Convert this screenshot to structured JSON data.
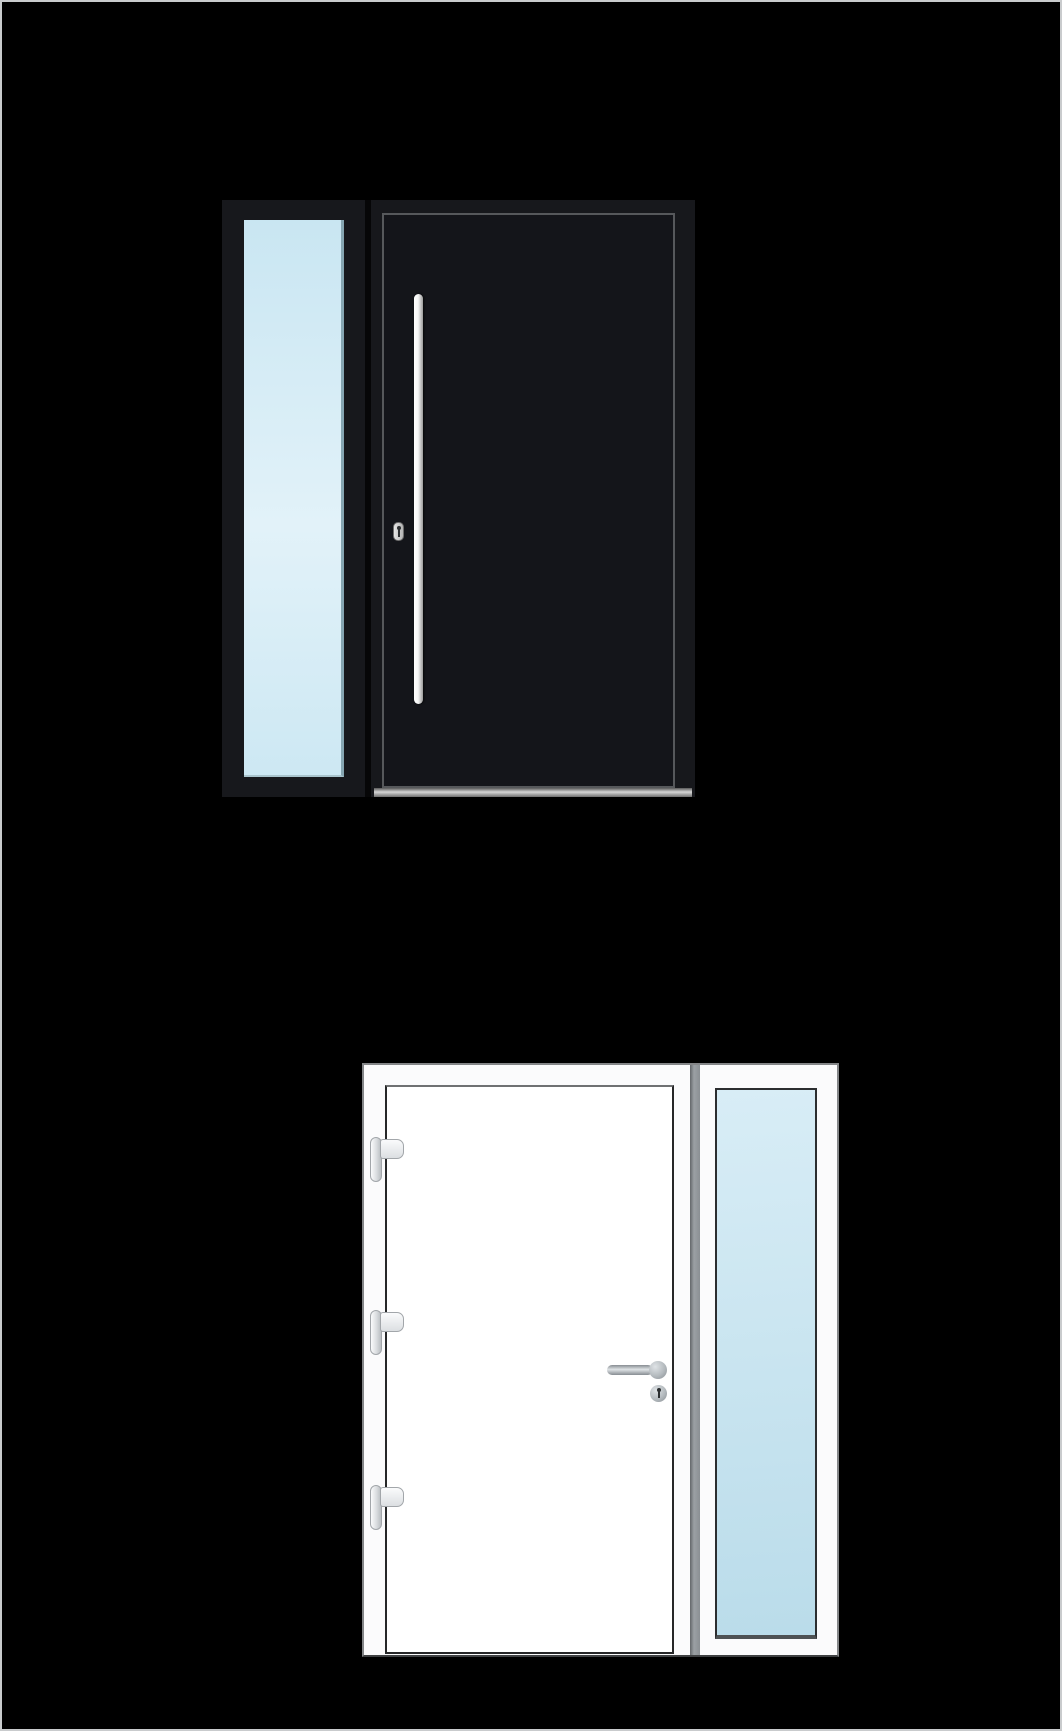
{
  "page": {
    "background_color": "#000000",
    "border_color": "#c9cbcd",
    "visible_text": ""
  },
  "colors": {
    "bg": "#000000",
    "page-border": "#c9cbcd",
    "gap-black": "#060607",
    "keyhole": "#2c2f31",
    "d1-frame": "#17181c",
    "d1-panel": "#14151a",
    "d1-outline": "#56585b",
    "d1-glass-top": "#c9e6f2",
    "d1-glass-mid": "#e2f2f9",
    "d1-glass-bot": "#cde8f3",
    "d1-glass-edge": "#86a6b2",
    "d1-handle": "#f7f7f7",
    "d1-handle-shade": "#9b9b9b",
    "d1-threshold-hi": "#d6d6d6",
    "d1-threshold-lo": "#6f6f6f",
    "d2-frame": "#fbfbfc",
    "d2-edge": "#848688",
    "d2-edge-dark": "#3f4143",
    "d2-leaf": "#ffffff",
    "d2-leaf-outline": "#262728",
    "d2-leaf-outline-top": "#6f7173",
    "d2-divider-hi": "#9ba0a4",
    "d2-divider-lo": "#63676a",
    "d2-glass-top": "#d8edf6",
    "d2-glass-bot": "#badcea",
    "d2-glass-edge": "#2c2e30",
    "metal-hi": "#dfe3e6",
    "metal-mid": "#b4babe",
    "metal-lo": "#878d92",
    "hinge-border": "#a2a6aa"
  },
  "products": [
    {
      "id": "dark-entry-door-left-sidelight",
      "door_finish_color": "#17181c",
      "leaf_color": "#14151a",
      "leaf_outline_color": "#56585b",
      "glass_tint_top": "#c9e6f2",
      "glass_tint_bottom": "#cde8f3",
      "sidelight_side": "left",
      "handle_style": "vertical-bar-pull",
      "handle_color": "#f7f7f7",
      "lock_style": "euro-cylinder-keyhole",
      "threshold_finish": "silver",
      "hinge_count_visible": 0
    },
    {
      "id": "white-entry-door-right-sidelight",
      "door_finish_color": "#fbfbfc",
      "leaf_color": "#ffffff",
      "leaf_outline_color": "#262728",
      "glass_tint_top": "#d8edf6",
      "glass_tint_bottom": "#badcea",
      "sidelight_side": "right",
      "handle_style": "lever-handle",
      "handle_color": "#b4babe",
      "lock_style": "round-cylinder-keyhole",
      "threshold_finish": "none",
      "hinge_count_visible": 3,
      "hinge_color": "#eef0f2"
    }
  ]
}
